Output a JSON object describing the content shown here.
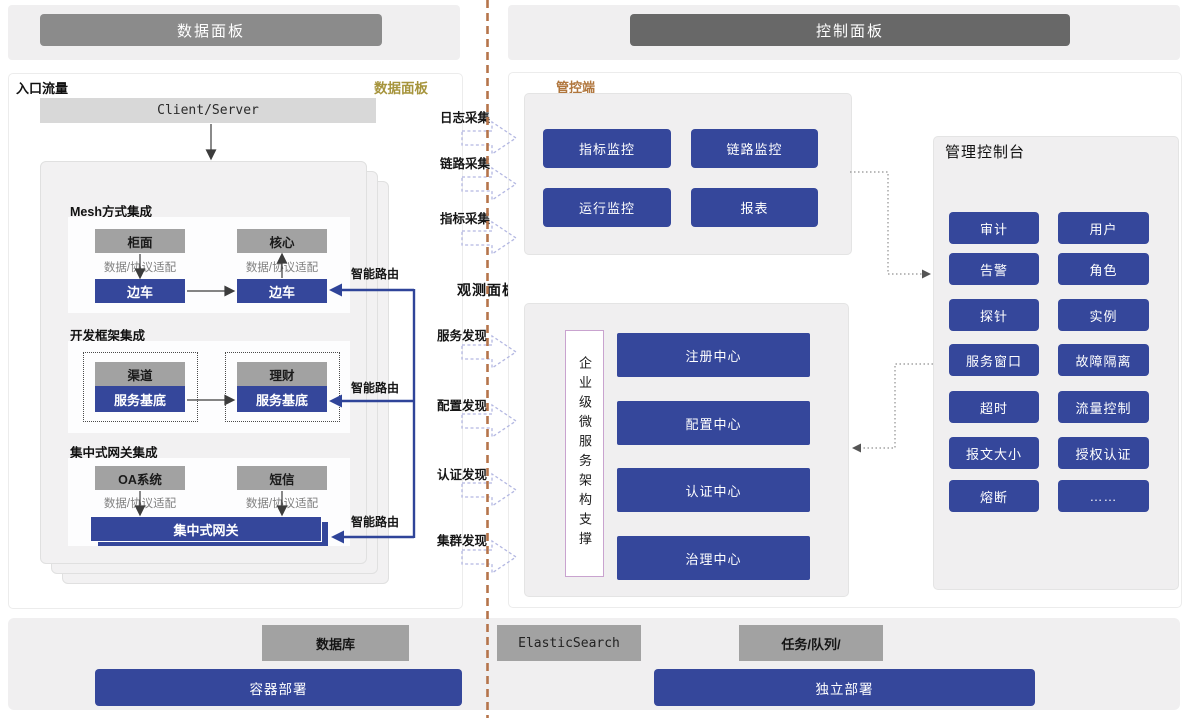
{
  "header": {
    "left_title": "数据面板",
    "right_title": "控制面板"
  },
  "data_panel": {
    "entry_label": "入口流量",
    "corner_label": "数据面板",
    "client_server": "Client/Server",
    "mesh": {
      "title": "Mesh方式集成",
      "left_top": "柜面",
      "right_top": "核心",
      "adapter": "数据/协议适配",
      "left_sidecar": "边车",
      "right_sidecar": "边车"
    },
    "framework": {
      "title": "开发框架集成",
      "left_top": "渠道",
      "right_top": "理财",
      "left_base": "服务基底",
      "right_base": "服务基底"
    },
    "gateway": {
      "title": "集中式网关集成",
      "left_top": "OA系统",
      "right_top": "短信",
      "adapter": "数据/协议适配",
      "bar": "集中式网关"
    },
    "smart_route": "智能路由"
  },
  "flow": {
    "collect": [
      "日志采集",
      "链路采集",
      "指标采集"
    ],
    "observe_title": "观测面板",
    "discover": [
      "服务发现",
      "配置发现",
      "认证发现",
      "集群发现"
    ]
  },
  "control_panel": {
    "corner_label": "管控端",
    "monitors": [
      "指标监控",
      "链路监控",
      "运行监控",
      "报表"
    ],
    "support_label": "企业级微服务架构支撑",
    "centers": [
      "注册中心",
      "配置中心",
      "认证中心",
      "治理中心"
    ],
    "console": {
      "title": "管理控制台",
      "buttons": [
        "审计",
        "用户",
        "告警",
        "角色",
        "探针",
        "实例",
        "服务窗口",
        "故障隔离",
        "超时",
        "流量控制",
        "报文大小",
        "授权认证",
        "熔断",
        "……"
      ]
    }
  },
  "footer": {
    "infra": [
      "数据库",
      "ElasticSearch",
      "任务/队列/"
    ],
    "deploy": [
      "容器部署",
      "独立部署"
    ]
  },
  "colors": {
    "accent_blue": "#35479b",
    "header_left_gray": "#8b8b8b",
    "header_right_gray": "#686868",
    "gold_label": "#a6943c",
    "orange_label": "#b0763d",
    "divider_orange": "#b5744b"
  }
}
